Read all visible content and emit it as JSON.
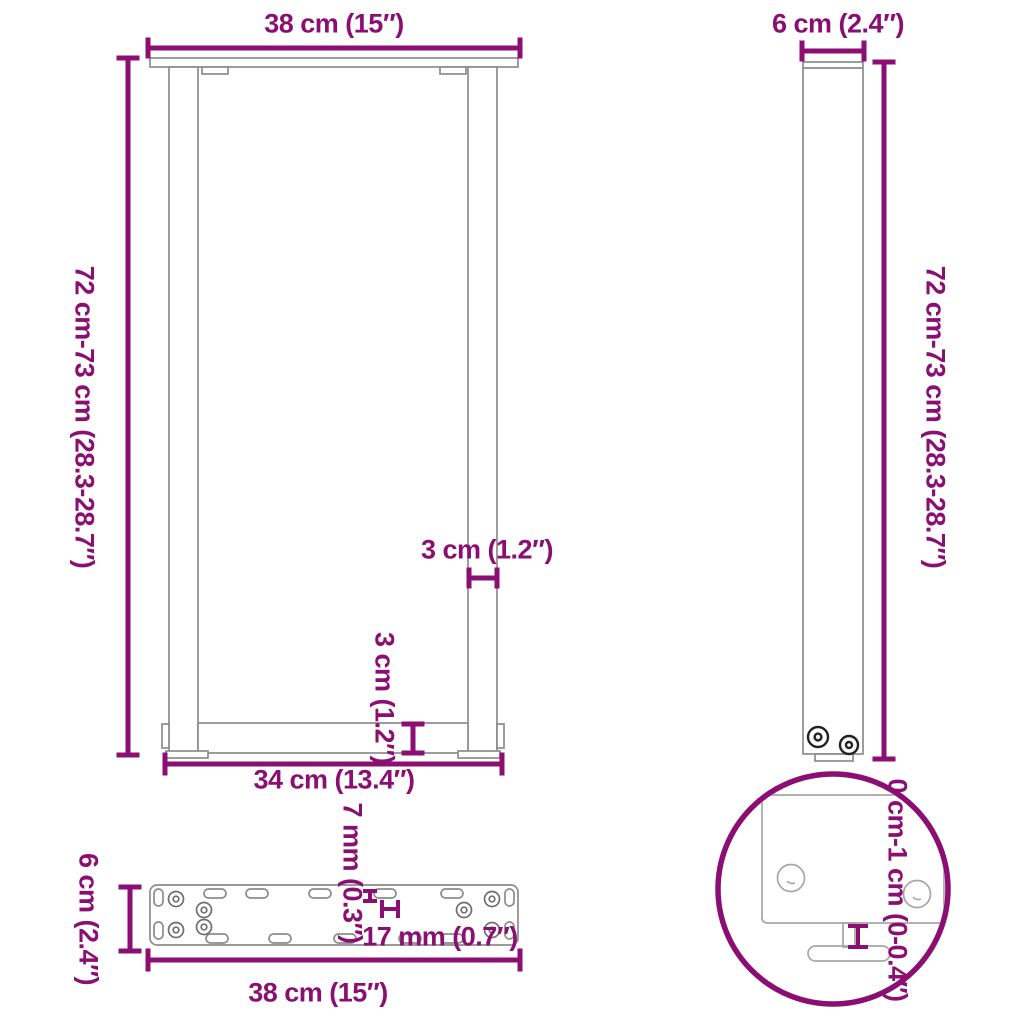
{
  "title": "Table leg dimensions diagram",
  "colors": {
    "accent_purple": "#8B0F72",
    "outline_gray": "#8C8C8C",
    "detail_gray": "#A6A6A6",
    "screw_dark": "#222222",
    "background": "#FFFFFF"
  },
  "views": {
    "front": {
      "name": "U-shaped leg front view",
      "dimensions": {
        "top_width": "38 cm (15″)",
        "height": "72 cm-73 cm (28.3-28.7″)",
        "profile_width": "3 cm (1.2″)",
        "crossbar_height": "3 cm (1.2″)",
        "bottom_width": "34 cm (13.4″)"
      }
    },
    "side": {
      "name": "leg side view",
      "dimensions": {
        "depth": "6 cm (2.4″)",
        "height": "72 cm-73 cm (28.3-28.7″)"
      }
    },
    "plate": {
      "name": "mounting plate top view",
      "dimensions": {
        "depth": "6 cm (2.4″)",
        "slot_width": "7 mm (0.3″)",
        "hole_size": "17 mm (0.7″)",
        "width": "38 cm (15″)"
      }
    },
    "detail": {
      "name": "adjustable foot detail",
      "dimensions": {
        "adjustment_range": "0 cm-1 cm (0-0.4″)"
      }
    }
  }
}
